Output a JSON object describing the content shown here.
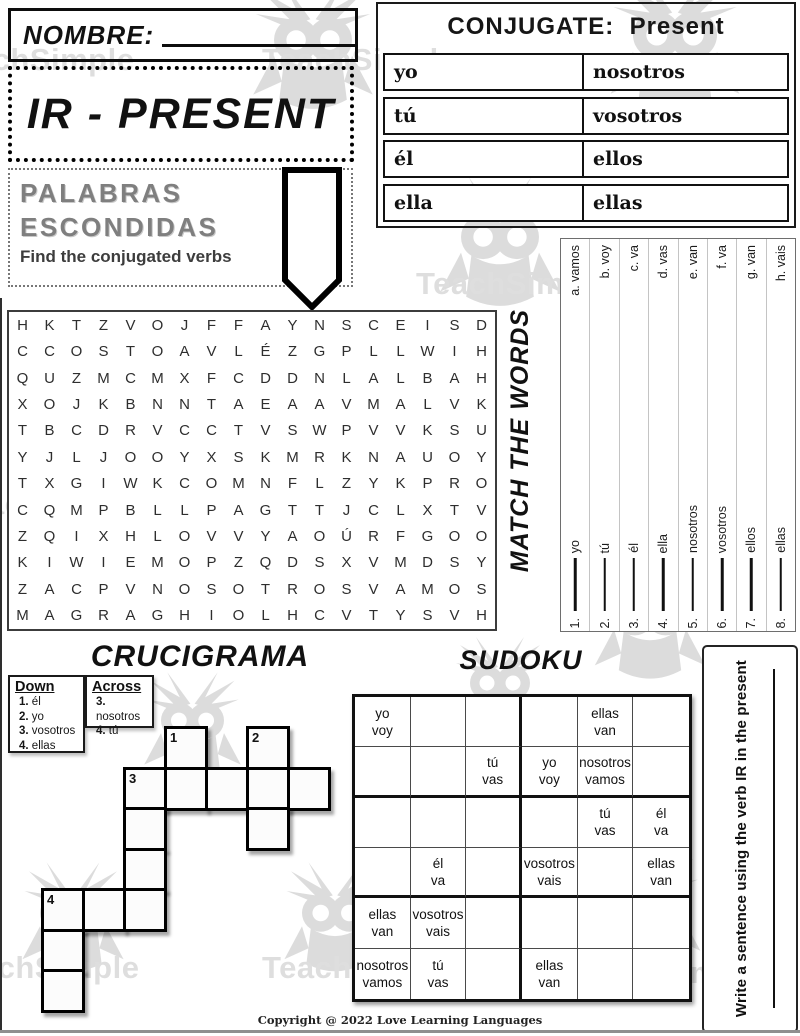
{
  "page": {
    "nombre_label": "NOMBRE:",
    "worksheet_title": "IR - PRESENT",
    "copyright": "Copyright @ 2022 Love Learning Languages",
    "watermark_text": "TeachSimple"
  },
  "conjugate": {
    "title": "CONJUGATE:  Present",
    "rows": [
      {
        "left": "yo",
        "right": "nosotros"
      },
      {
        "left": "tú",
        "right": "vosotros"
      },
      {
        "left": "él",
        "right": "ellos"
      },
      {
        "left": "ella",
        "right": "ellas"
      }
    ]
  },
  "palabras": {
    "title_line1": "PALABRAS",
    "title_line2": "ESCONDIDAS",
    "subtitle": "Find the conjugated verbs"
  },
  "word_search": {
    "rows": [
      "HKTZVOJFFAYNSCEISD",
      "CCOSTOAVLÉZGPLLWIH",
      "QUZMCMXFCDDNLALBAH",
      "XOJKBNNTAEAAVMALVK",
      "TBCDRVCCTVSWPVVKSU",
      "YJLJOOYXSKMRKNAUOY",
      "TXGIWKCOMNFLZYKPRO",
      "CQMPBLLPAGTTJCLXTV",
      "ZQIXHLOVVYAOÚRFGOO",
      "KIWIEMOPZQDSXVMDSY",
      "ZACPVNOSOTROSVAMOS",
      "MAGRAGHIOLHCVTYSVH"
    ]
  },
  "match_words": {
    "title": "MATCH THE WORDS",
    "items": [
      {
        "num": "1.",
        "pronoun": "yo",
        "option": "a. vamos"
      },
      {
        "num": "2.",
        "pronoun": "tú",
        "option": "b. voy"
      },
      {
        "num": "3.",
        "pronoun": "él",
        "option": "c. va"
      },
      {
        "num": "4.",
        "pronoun": "ella",
        "option": "d. vas"
      },
      {
        "num": "5.",
        "pronoun": "nosotros",
        "option": "e. van"
      },
      {
        "num": "6.",
        "pronoun": "vosotros",
        "option": "f. va"
      },
      {
        "num": "7.",
        "pronoun": "ellos",
        "option": "g. van"
      },
      {
        "num": "8.",
        "pronoun": "ellas",
        "option": "h. vais"
      }
    ]
  },
  "crucigrama": {
    "title": "CRUCIGRAMA",
    "down_label": "Down",
    "across_label": "Across",
    "down_clues": [
      "1. él",
      "2. yo",
      "3. vosotros",
      "4. ellas"
    ],
    "across_clues": [
      "3. nosotros",
      "4. tú"
    ],
    "cells": [
      {
        "c": 3,
        "r": 0,
        "n": "1"
      },
      {
        "c": 5,
        "r": 0,
        "n": "2"
      },
      {
        "c": 2,
        "r": 1,
        "n": "3"
      },
      {
        "c": 3,
        "r": 1
      },
      {
        "c": 4,
        "r": 1
      },
      {
        "c": 5,
        "r": 1
      },
      {
        "c": 6,
        "r": 1
      },
      {
        "c": 2,
        "r": 2
      },
      {
        "c": 5,
        "r": 2
      },
      {
        "c": 2,
        "r": 3
      },
      {
        "c": 0,
        "r": 4,
        "n": "4"
      },
      {
        "c": 1,
        "r": 4
      },
      {
        "c": 2,
        "r": 4
      },
      {
        "c": 0,
        "r": 5
      },
      {
        "c": 0,
        "r": 6
      }
    ]
  },
  "sudoku": {
    "title": "SUDOKU",
    "grid": [
      [
        "yo voy",
        "",
        "",
        "",
        "ellas van",
        ""
      ],
      [
        "",
        "",
        "tú vas",
        "yo voy",
        "nosotros vamos",
        ""
      ],
      [
        "",
        "",
        "",
        "",
        "tú vas",
        "él va"
      ],
      [
        "",
        "él va",
        "",
        "vosotros vais",
        "",
        "ellas van"
      ],
      [
        "ellas van",
        "vosotros vais",
        "",
        "",
        "",
        ""
      ],
      [
        "nosotros vamos",
        "tú vas",
        "",
        "ellas van",
        "",
        ""
      ]
    ]
  },
  "write_sentence": {
    "label": "Write a sentence using the verb IR in the present"
  }
}
